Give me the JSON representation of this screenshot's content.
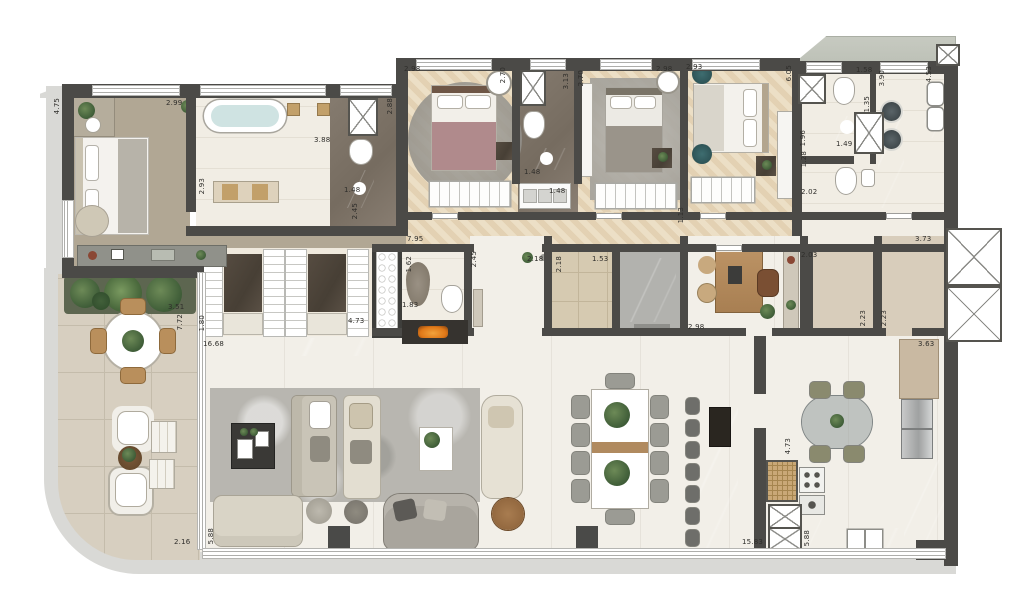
{
  "plan_type": "residential-apartment-floor-plan",
  "colors": {
    "wall": "#4b4a47",
    "wood_floor": "#e7d7bb",
    "carpet": "#b1a794",
    "marble_floor": "#f2efe8",
    "dark_stone": "#7f756a",
    "counter_dark": "#4e463c",
    "terrace_tile": "#d7cfc0",
    "hall_tile": "#d6cab1",
    "slab_edge": "#d9d9d6",
    "accent_teal": "#2f5b5e",
    "accent_green": "#4e6b42",
    "fire": "#e07818",
    "elevator_cab": "#1c1c1c",
    "tub_water": "#cfe3e2"
  },
  "dimensions": [
    {
      "text": "4.75",
      "x": 54,
      "y": 98,
      "v": 1
    },
    {
      "text": "2.99",
      "x": 166,
      "y": 100
    },
    {
      "text": "3.88",
      "x": 314,
      "y": 137
    },
    {
      "text": "2.93",
      "x": 199,
      "y": 178,
      "v": 1
    },
    {
      "text": "1.48",
      "x": 344,
      "y": 187
    },
    {
      "text": "2.45",
      "x": 352,
      "y": 203,
      "v": 1
    },
    {
      "text": "2.88",
      "x": 387,
      "y": 98,
      "v": 1
    },
    {
      "text": "2.98",
      "x": 404,
      "y": 66
    },
    {
      "text": "2.70",
      "x": 500,
      "y": 67,
      "v": 1
    },
    {
      "text": "3.13",
      "x": 563,
      "y": 73,
      "v": 1
    },
    {
      "text": "2.70",
      "x": 578,
      "y": 70,
      "v": 1
    },
    {
      "text": "1.48",
      "x": 524,
      "y": 169
    },
    {
      "text": "1.48",
      "x": 549,
      "y": 188
    },
    {
      "text": "2.98",
      "x": 656,
      "y": 66
    },
    {
      "text": "2.93",
      "x": 686,
      "y": 64
    },
    {
      "text": "1.13",
      "x": 678,
      "y": 207,
      "v": 1
    },
    {
      "text": "7.95",
      "x": 407,
      "y": 236
    },
    {
      "text": "6.05",
      "x": 786,
      "y": 65,
      "v": 1
    },
    {
      "text": "1.58",
      "x": 856,
      "y": 67
    },
    {
      "text": "3.90",
      "x": 879,
      "y": 70,
      "v": 1
    },
    {
      "text": "4.53",
      "x": 926,
      "y": 66,
      "v": 1
    },
    {
      "text": "1.35",
      "x": 864,
      "y": 96,
      "v": 1
    },
    {
      "text": "1.96",
      "x": 800,
      "y": 130,
      "v": 1
    },
    {
      "text": "1.49",
      "x": 836,
      "y": 141
    },
    {
      "text": "1.28",
      "x": 801,
      "y": 151,
      "v": 1
    },
    {
      "text": "2.02",
      "x": 801,
      "y": 189
    },
    {
      "text": "3.73",
      "x": 915,
      "y": 236
    },
    {
      "text": "1.62",
      "x": 406,
      "y": 256,
      "v": 1
    },
    {
      "text": "1.83",
      "x": 402,
      "y": 302
    },
    {
      "text": "2.45",
      "x": 471,
      "y": 251,
      "v": 1
    },
    {
      "text": "2.18",
      "x": 527,
      "y": 256
    },
    {
      "text": "2.18",
      "x": 556,
      "y": 256,
      "v": 1
    },
    {
      "text": "1.53",
      "x": 592,
      "y": 256
    },
    {
      "text": "2.03",
      "x": 801,
      "y": 252
    },
    {
      "text": "2.23",
      "x": 860,
      "y": 310,
      "v": 1
    },
    {
      "text": "2.23",
      "x": 881,
      "y": 310,
      "v": 1
    },
    {
      "text": "3.51",
      "x": 168,
      "y": 304
    },
    {
      "text": "7.72",
      "x": 177,
      "y": 314,
      "v": 1
    },
    {
      "text": "1.80",
      "x": 199,
      "y": 315,
      "v": 1
    },
    {
      "text": "4.73",
      "x": 348,
      "y": 318
    },
    {
      "text": "16.68",
      "x": 203,
      "y": 341
    },
    {
      "text": "2.98",
      "x": 688,
      "y": 324
    },
    {
      "text": "3.63",
      "x": 918,
      "y": 341
    },
    {
      "text": "2.16",
      "x": 174,
      "y": 539
    },
    {
      "text": "5.88",
      "x": 208,
      "y": 528,
      "v": 1
    },
    {
      "text": "4.73",
      "x": 785,
      "y": 438,
      "v": 1
    },
    {
      "text": "15.83",
      "x": 742,
      "y": 539
    },
    {
      "text": "5.88",
      "x": 804,
      "y": 530,
      "v": 1
    }
  ]
}
